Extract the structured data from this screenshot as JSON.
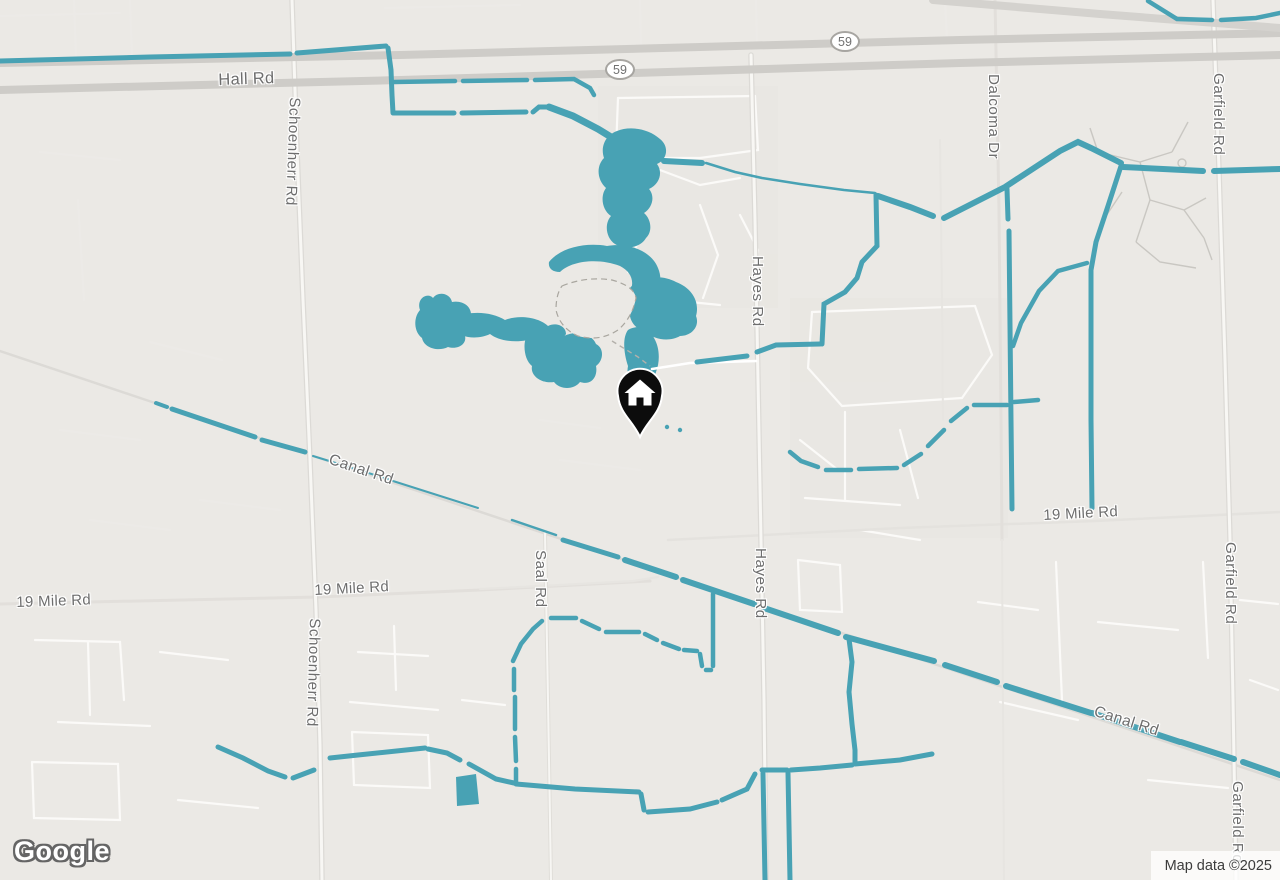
{
  "map": {
    "provider_logo": "Google",
    "attribution": "Map data ©2025",
    "marker": {
      "type": "home"
    },
    "route_shields": [
      {
        "route": "59"
      },
      {
        "route": "59"
      }
    ],
    "colors": {
      "water": "#48A2B4",
      "land": "#EBE9E5",
      "road_major": "#CECCC8",
      "road_minor": "#F7F6F3",
      "label_text": "#6E6E6E",
      "marker": "#0C0C0C"
    },
    "labels": {
      "hall_rd": "Hall Rd",
      "schoenherr_rd_top": "Schoenherr Rd",
      "schoenherr_rd_bottom": "Schoenherr Rd",
      "hayes_rd_top": "Hayes Rd",
      "hayes_rd_bottom": "Hayes Rd",
      "dalcoma_dr": "Dalcoma Dr",
      "garfield_rd_top": "Garfield Rd",
      "garfield_rd_middle": "Garfield Rd",
      "garfield_rd_bottom": "Garfield Rd",
      "canal_rd_left": "Canal Rd",
      "canal_rd_right": "Canal Rd",
      "mile19_left": "19 Mile Rd",
      "mile19_center": "19 Mile Rd",
      "mile19_right": "19 Mile Rd",
      "saal_rd": "Saal Rd"
    }
  }
}
